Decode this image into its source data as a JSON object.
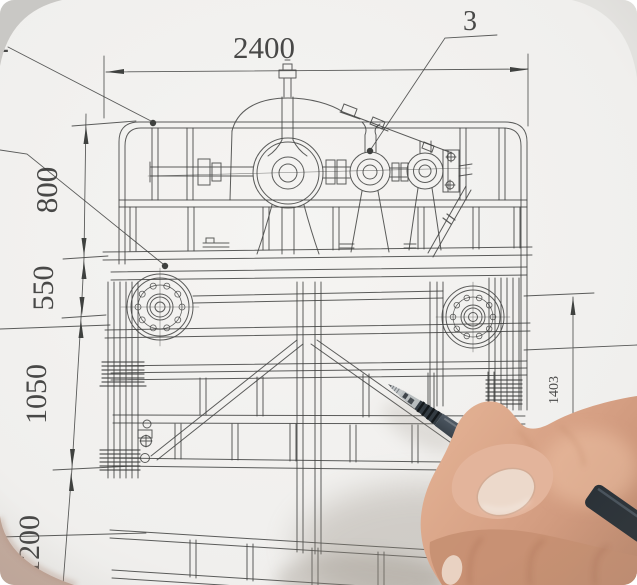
{
  "photo": {
    "subject": "hand holding pen over technical drawing",
    "colors": {
      "paper": "#f3f2f0",
      "paper_edge": "#e6e5e2",
      "backdrop_top_left": "#c9c8c5",
      "backdrop_top_right": "#e2e1de",
      "backdrop_bottom_left": "#c4a99b",
      "drawing_line": "#3f413f",
      "pen_barrel": "#46505a",
      "pen_grip": "#333b42",
      "pen_tip_metal": "#c2c6c8",
      "skin_base": "#d6a084",
      "skin_highlight": "#eec3a6",
      "skin_shadow": "#c28d74",
      "thumb_nail": "#ecd9cb"
    }
  },
  "drawing": {
    "callouts": [
      {
        "value": "2"
      },
      {
        "value": "3"
      }
    ],
    "dimensions": {
      "top": {
        "value": "2400"
      },
      "left": [
        {
          "value": "800"
        },
        {
          "value": "550"
        },
        {
          "value": "1050"
        },
        {
          "value": "1200"
        }
      ],
      "right": [
        {
          "value": "1403"
        }
      ]
    }
  }
}
